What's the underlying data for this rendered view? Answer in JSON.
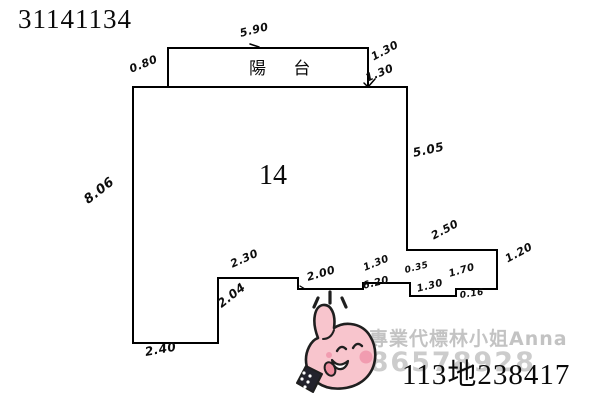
{
  "header": {
    "doc_number": "31141134"
  },
  "plan": {
    "unit_label": "14",
    "balcony_label": "陽 台",
    "measurements": {
      "balcony_top": "5.90",
      "balcony_left": "0.80",
      "balcony_right_upper": "1.30",
      "balcony_right_lower": "1.30",
      "right_wall": "5.05",
      "left_wall": "8.06",
      "upper_step": "2.50",
      "right_lower_wall": "1.20",
      "lower_seg_a": "1.70",
      "lower_step_a": "0.16",
      "lower_seg_b": "1.30",
      "lower_step_b": "0.35",
      "lower_seg_c": "1.30",
      "lower_total": "6.20",
      "lower_seg_d": "2.00",
      "lower_seg_e": "2.30",
      "annex_right": "2.04",
      "annex_bottom": "2.40"
    }
  },
  "watermark": {
    "agent_name": "專業代標林小姐Anna",
    "agent_phone": "0986578928"
  },
  "footer": {
    "case_number": "113地238417"
  },
  "colors": {
    "line": "#000000",
    "watermark_gray": "#c6c6c6",
    "sticker_pink": "#f8c5cd",
    "sticker_blush": "#f19cb0",
    "sticker_outline": "#1f1f1f"
  }
}
